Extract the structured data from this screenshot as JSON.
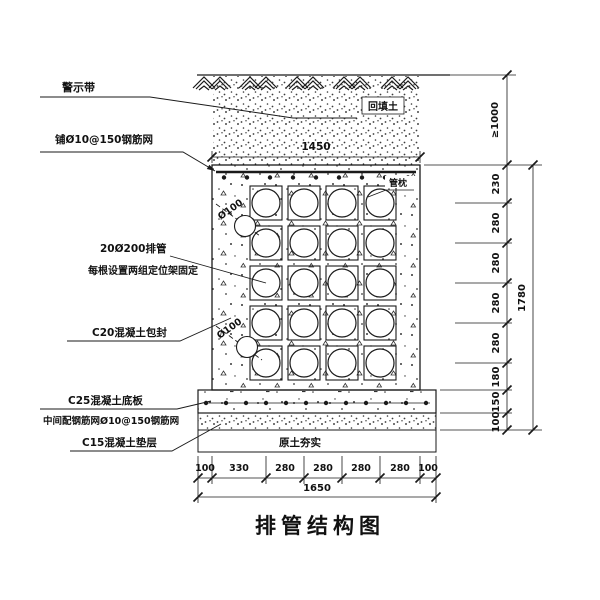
{
  "drawing_title": "排管结构图",
  "annotations": {
    "warning_tape": "警示带",
    "top_mesh": "铺Ø10@150钢筋网",
    "pipes_count": "20Ø200排管",
    "pipes_fixing": "每根设置两组定位架固定",
    "encasement": "C20混凝土包封",
    "base_slab": "C25混凝土底板",
    "slab_mesh": "中间配钢筋网Ø10@150钢筋网",
    "cushion": "C15混凝土垫层",
    "backfill": "回填土",
    "pipe_pillow": "管枕",
    "compacted_soil": "原土夯实",
    "small_pipe_dia": "Ø100"
  },
  "dimensions": {
    "top_width": "1450",
    "cover_depth": "≥1000",
    "right_segments": [
      "230",
      "280",
      "280",
      "280",
      "280",
      "180",
      "150",
      "100"
    ],
    "right_total": "1780",
    "bottom_segments": [
      "100",
      "330",
      "280",
      "280",
      "280",
      "280",
      "100"
    ],
    "bottom_total": "1650"
  },
  "structure": {
    "pipe_rows": 5,
    "pipe_cols": 4,
    "pipe_count": 20
  },
  "colors": {
    "line": "#1a1a1a",
    "background": "#ffffff"
  }
}
